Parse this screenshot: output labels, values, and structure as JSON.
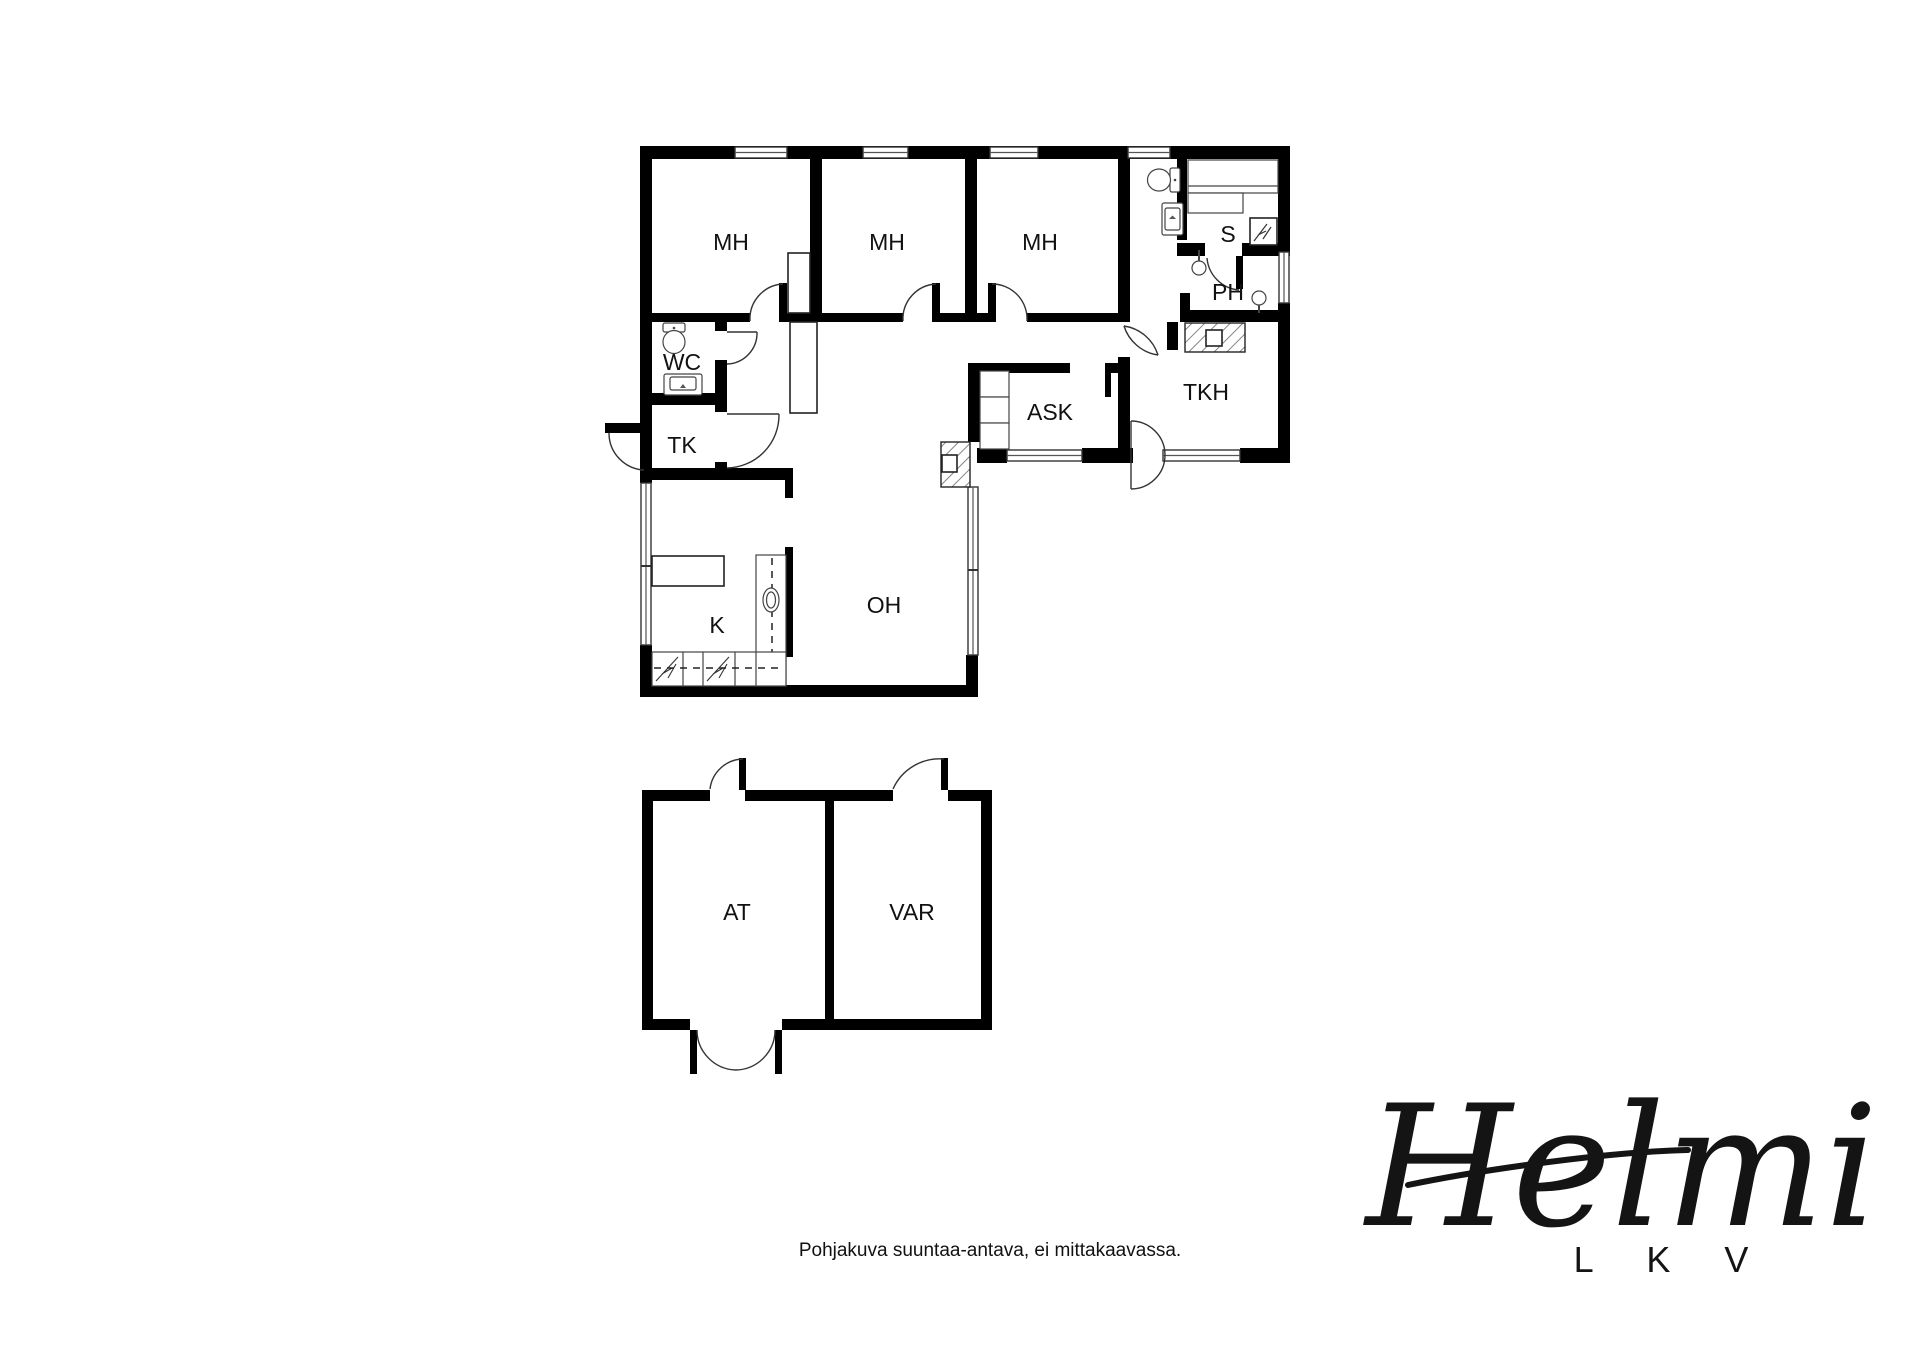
{
  "floor_plan": {
    "rooms": {
      "mh1": {
        "label": "MH"
      },
      "mh2": {
        "label": "MH"
      },
      "mh3": {
        "label": "MH"
      },
      "s": {
        "label": "S"
      },
      "ph": {
        "label": "PH"
      },
      "wc": {
        "label": "WC"
      },
      "tk": {
        "label": "TK"
      },
      "ask": {
        "label": "ASK"
      },
      "tkh": {
        "label": "TKH"
      },
      "oh": {
        "label": "OH"
      },
      "k": {
        "label": "K"
      },
      "at": {
        "label": "AT"
      },
      "var": {
        "label": "VAR"
      }
    },
    "fixtures": [
      "toilet",
      "sink",
      "sauna-benches",
      "sauna-stove",
      "shower",
      "fireplace",
      "kitchen-counter",
      "kitchen-table",
      "closet",
      "stove"
    ],
    "colors": {
      "wall": "#000000",
      "background": "#ffffff",
      "hatch": "#777777"
    },
    "caption": "Pohjakuva suuntaa-antava, ei mittakaavassa."
  },
  "logo": {
    "brand": "Helmi",
    "sub": "L K V"
  }
}
